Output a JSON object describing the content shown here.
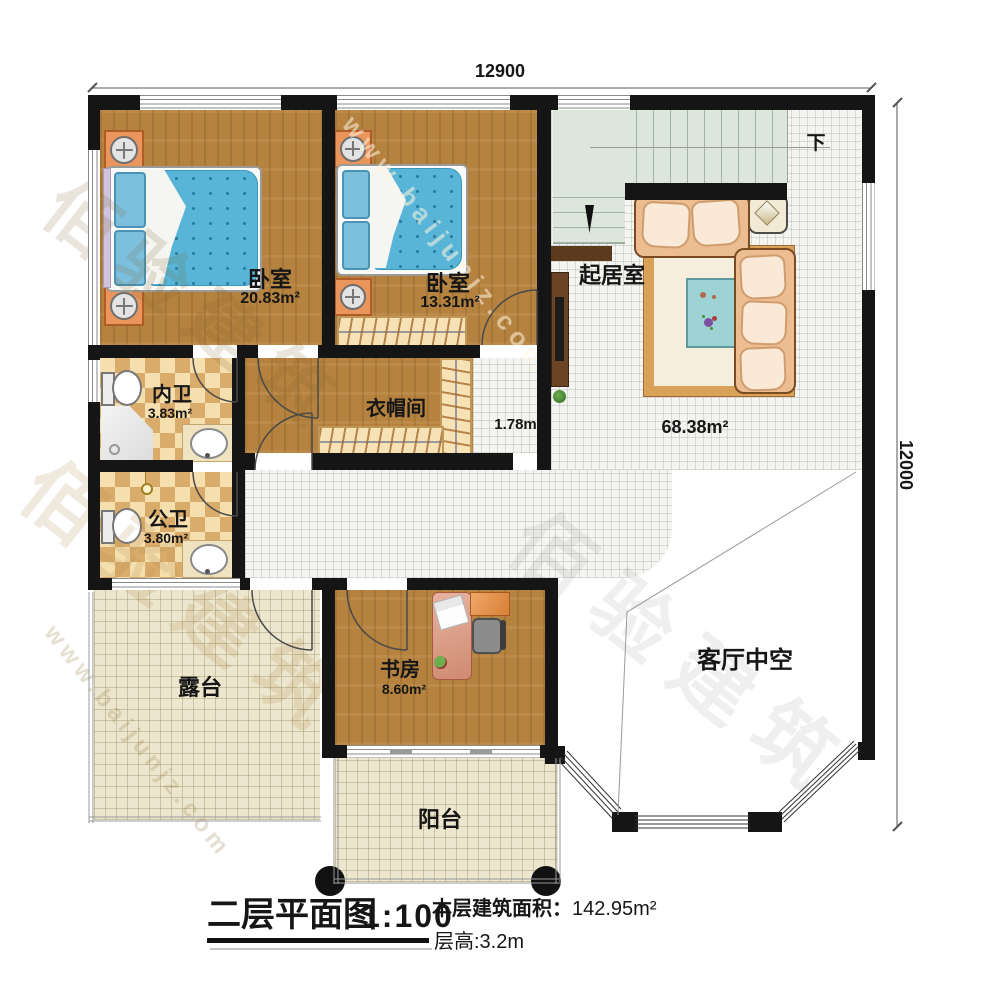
{
  "dimensions": {
    "top": "12900",
    "right": "12000"
  },
  "stairs": {
    "down_label": "下"
  },
  "rooms": {
    "bedroom1": {
      "label": "卧室",
      "area": "20.83m²"
    },
    "bedroom2": {
      "label": "卧室",
      "area": "13.31m²"
    },
    "living": {
      "label": "起居室",
      "area": "68.38m²"
    },
    "inner_bath": {
      "label": "内卫",
      "area": "3.83m²"
    },
    "public_bath": {
      "label": "公卫",
      "area": "3.80m²"
    },
    "cloakroom": {
      "label": "衣帽间"
    },
    "hallway": {
      "area": "1.78m²"
    },
    "study": {
      "label": "书房",
      "area": "8.60m²"
    },
    "terrace": {
      "label": "露台"
    },
    "balcony": {
      "label": "阳台"
    },
    "void": {
      "label": "客厅中空"
    }
  },
  "caption": {
    "title": "二层平面图",
    "scale": "1:100",
    "area_label": "本层建筑面积：",
    "area_value": "142.95m²",
    "height_label": "层高:3.2m"
  },
  "watermark": {
    "cn": "佰验建筑",
    "url": "www.baijunjz.com"
  }
}
